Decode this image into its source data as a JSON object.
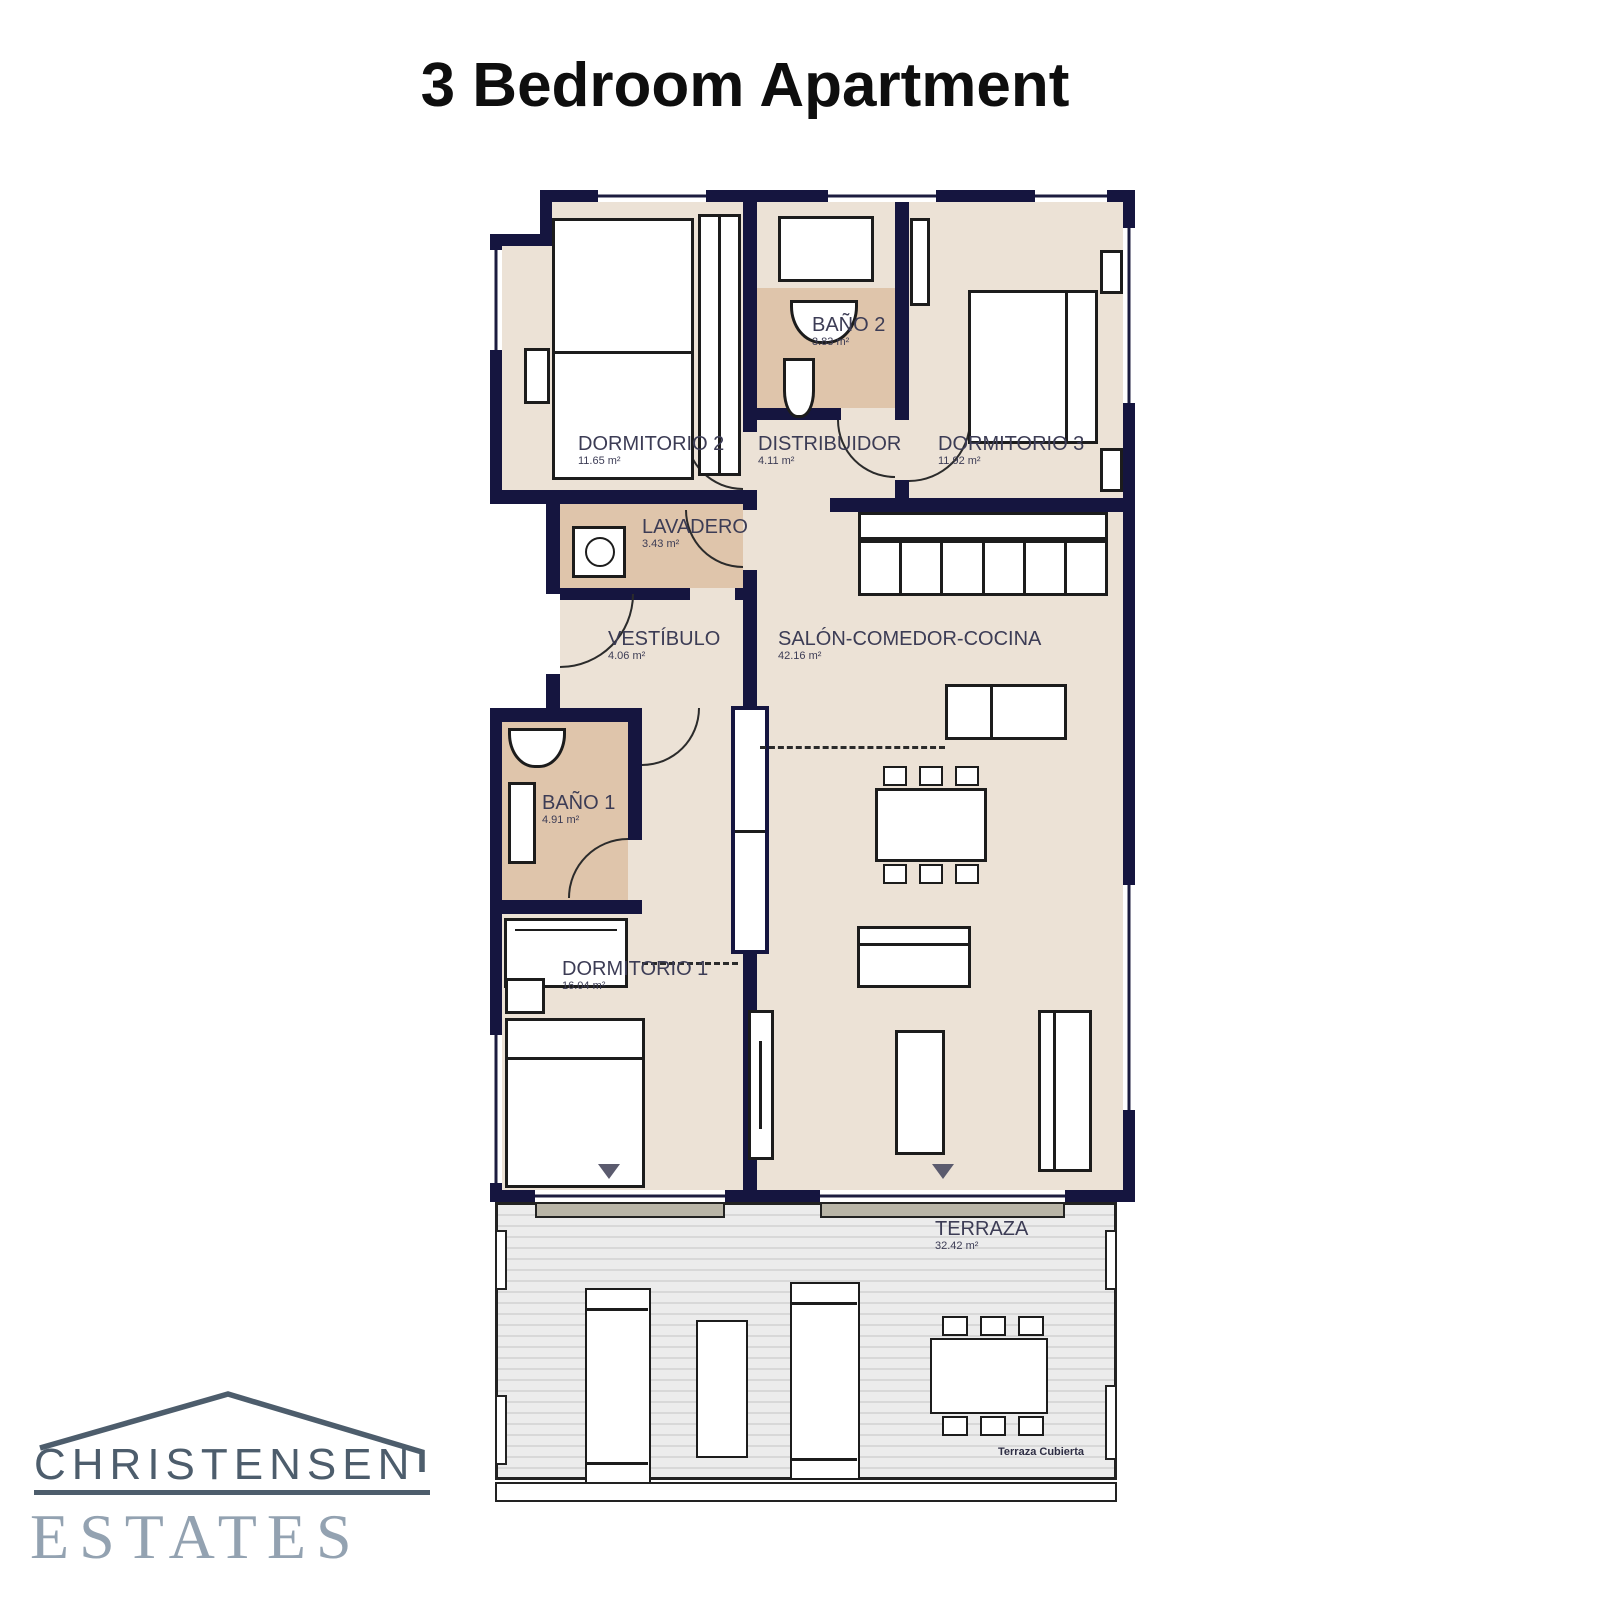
{
  "title": "3 Bedroom Apartment",
  "plan": {
    "rooms": [
      {
        "name": "DORMITORIO 2",
        "area": "11.65 m²"
      },
      {
        "name": "BAÑO 2",
        "area": "3.83 m²"
      },
      {
        "name": "DISTRIBUIDOR",
        "area": "4.11 m²"
      },
      {
        "name": "DORMITORIO 3",
        "area": "11.92 m²"
      },
      {
        "name": "LAVADERO",
        "area": "3.43 m²"
      },
      {
        "name": "VESTÍBULO",
        "area": "4.06 m²"
      },
      {
        "name": "SALÓN-COMEDOR-COCINA",
        "area": "42.16 m²"
      },
      {
        "name": "BAÑO 1",
        "area": "4.91 m²"
      },
      {
        "name": "DORMITORIO 1",
        "area": "16.04 m²"
      },
      {
        "name": "TERRAZA",
        "area": "32.42 m²"
      }
    ],
    "terrace_note": "Terraza Cubierta"
  },
  "logo": {
    "top": "CHRISTENSEN",
    "bottom": "ESTATES"
  },
  "colors": {
    "wall": "#15153f",
    "floor": "#ece2d6",
    "bath": "#dfc5ab",
    "label": "#3c3c55",
    "logo_dark": "#4d5d6c",
    "logo_light": "#93a2b1"
  }
}
